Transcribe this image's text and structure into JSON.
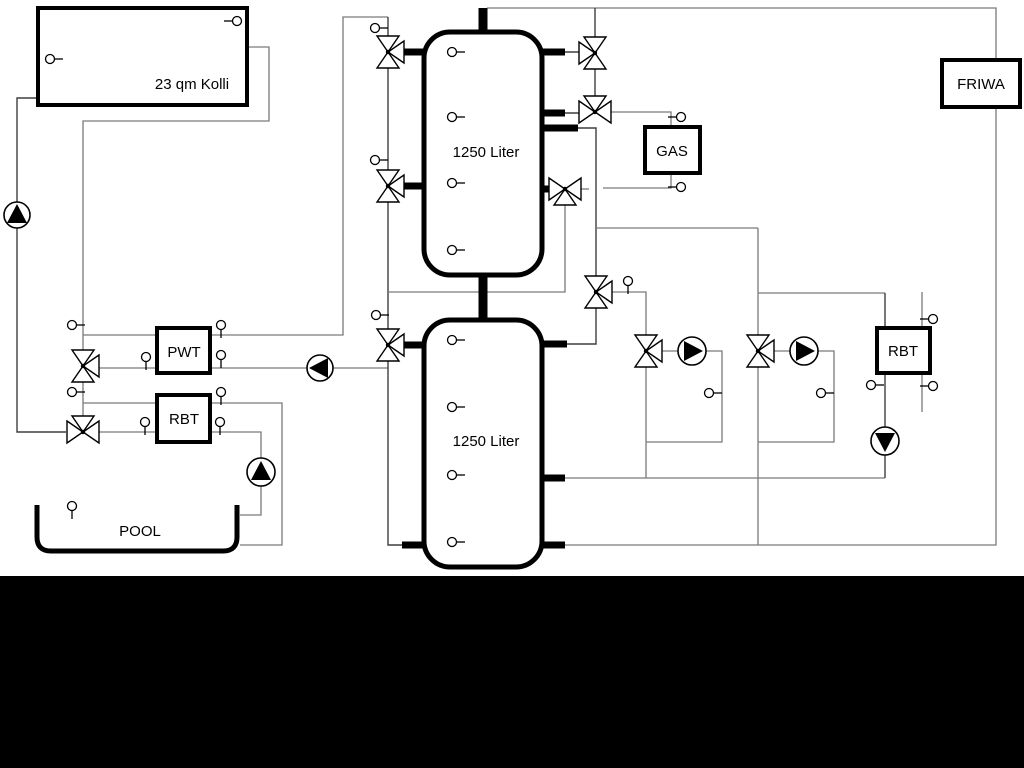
{
  "canvas": {
    "width": 1024,
    "height": 768,
    "background": "#ffffff",
    "footer_color": "#000000"
  },
  "colors": {
    "pipe": "#7a7a7a",
    "pipe_dark": "#3f3f3f",
    "outline": "#000000",
    "symbol_fill": "#ffffff"
  },
  "labels": {
    "collector": "23 qm Kolli",
    "tank_top": "1250 Liter",
    "tank_bottom": "1250 Liter",
    "pwt": "PWT",
    "rbt_left": "RBT",
    "pool": "POOL",
    "gas": "GAS",
    "friwa": "FRIWA",
    "rbt_right": "RBT"
  },
  "valves": [
    {
      "id": "tank1-top-left",
      "x": 388,
      "y": 52,
      "ports": "NSE"
    },
    {
      "id": "tank1-mid-left",
      "x": 388,
      "y": 186,
      "ports": "NSE"
    },
    {
      "id": "tank2-top-left",
      "x": 388,
      "y": 345,
      "ports": "NSE"
    },
    {
      "id": "pwt-supply",
      "x": 83,
      "y": 366,
      "ports": "NSE"
    },
    {
      "id": "rbt-supply",
      "x": 83,
      "y": 432,
      "ports": "WEN"
    },
    {
      "id": "tank1-top-right",
      "x": 595,
      "y": 53,
      "ports": "NSW"
    },
    {
      "id": "gas-supply",
      "x": 595,
      "y": 112,
      "ports": "WEN"
    },
    {
      "id": "tank1-mid-right",
      "x": 565,
      "y": 189,
      "ports": "WES"
    },
    {
      "id": "heating-header",
      "x": 596,
      "y": 292,
      "ports": "NSE"
    },
    {
      "id": "circuit-1",
      "x": 646,
      "y": 351,
      "ports": "NSE"
    },
    {
      "id": "circuit-2",
      "x": 758,
      "y": 351,
      "ports": "NSE"
    }
  ],
  "pumps": [
    {
      "id": "collector-riser",
      "x": 17,
      "y": 215,
      "r": 13,
      "dir": "up"
    },
    {
      "id": "pwt-secondary",
      "x": 320,
      "y": 368,
      "r": 13,
      "dir": "left"
    },
    {
      "id": "pool-loop",
      "x": 261,
      "y": 472,
      "r": 14,
      "dir": "up"
    },
    {
      "id": "circuit-1",
      "x": 692,
      "y": 351,
      "r": 14,
      "dir": "right"
    },
    {
      "id": "circuit-2",
      "x": 804,
      "y": 351,
      "r": 14,
      "dir": "right"
    },
    {
      "id": "rbt-right-loop",
      "x": 885,
      "y": 441,
      "r": 14,
      "dir": "down"
    }
  ],
  "sensors": [
    {
      "id": "collector-left",
      "x": 50,
      "y": 59,
      "stem": "right"
    },
    {
      "id": "collector-top",
      "x": 237,
      "y": 21,
      "stem": "left"
    },
    {
      "id": "left-column-top",
      "x": 375,
      "y": 28,
      "stem": "right"
    },
    {
      "id": "left-column-mid",
      "x": 375,
      "y": 160,
      "stem": "right"
    },
    {
      "id": "left-column-low",
      "x": 376,
      "y": 315,
      "stem": "right"
    },
    {
      "id": "tank1-1",
      "x": 452,
      "y": 52,
      "stem": "right"
    },
    {
      "id": "tank1-2",
      "x": 452,
      "y": 117,
      "stem": "right"
    },
    {
      "id": "tank1-3",
      "x": 452,
      "y": 183,
      "stem": "right"
    },
    {
      "id": "tank1-4",
      "x": 452,
      "y": 250,
      "stem": "right"
    },
    {
      "id": "tank2-1",
      "x": 452,
      "y": 340,
      "stem": "right"
    },
    {
      "id": "tank2-2",
      "x": 452,
      "y": 407,
      "stem": "right"
    },
    {
      "id": "tank2-3",
      "x": 452,
      "y": 475,
      "stem": "right"
    },
    {
      "id": "tank2-4",
      "x": 452,
      "y": 542,
      "stem": "right"
    },
    {
      "id": "pwt-riser",
      "x": 72,
      "y": 325,
      "stem": "right"
    },
    {
      "id": "pwt-in-left",
      "x": 146,
      "y": 357,
      "stem": "down"
    },
    {
      "id": "pwt-out-top",
      "x": 221,
      "y": 325,
      "stem": "down"
    },
    {
      "id": "pwt-out-right",
      "x": 221,
      "y": 355,
      "stem": "down"
    },
    {
      "id": "rbt-riser",
      "x": 72,
      "y": 392,
      "stem": "right"
    },
    {
      "id": "rbt-in-left",
      "x": 145,
      "y": 422,
      "stem": "down"
    },
    {
      "id": "rbt-out-top",
      "x": 221,
      "y": 392,
      "stem": "down"
    },
    {
      "id": "rbt-out-right",
      "x": 220,
      "y": 422,
      "stem": "down"
    },
    {
      "id": "pool-water",
      "x": 72,
      "y": 506,
      "stem": "down"
    },
    {
      "id": "heating-header",
      "x": 628,
      "y": 281,
      "stem": "down"
    },
    {
      "id": "gas-in",
      "x": 681,
      "y": 117,
      "stem": "left"
    },
    {
      "id": "gas-out",
      "x": 681,
      "y": 187,
      "stem": "left"
    },
    {
      "id": "circuit-1-return",
      "x": 709,
      "y": 393,
      "stem": "right"
    },
    {
      "id": "circuit-2-return",
      "x": 821,
      "y": 393,
      "stem": "right"
    },
    {
      "id": "rbt-right-lower",
      "x": 871,
      "y": 385,
      "stem": "right"
    },
    {
      "id": "dhw-upper",
      "x": 933,
      "y": 319,
      "stem": "left"
    },
    {
      "id": "dhw-lower",
      "x": 933,
      "y": 386,
      "stem": "left"
    }
  ]
}
